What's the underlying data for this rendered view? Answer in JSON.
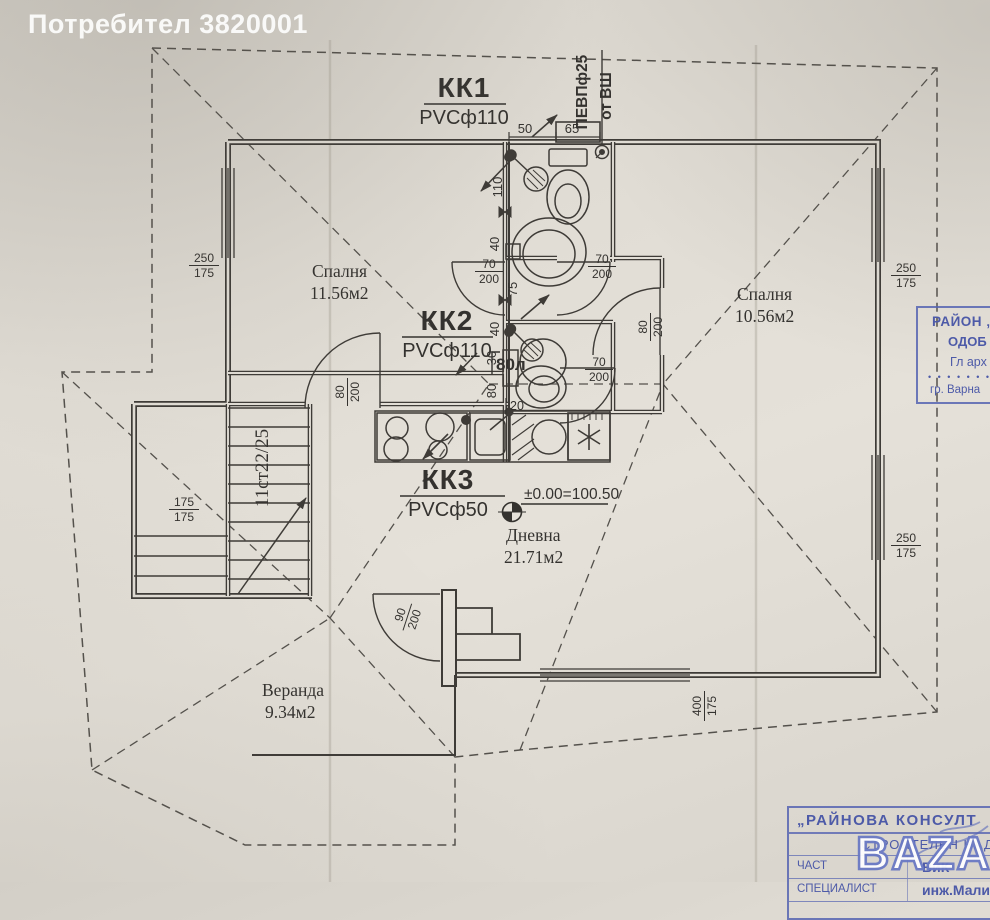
{
  "header": {
    "user_label": "Потребител 3820001"
  },
  "colors": {
    "stamp_blue": "#4d5aa8",
    "line_dark": "#3e3b37"
  },
  "plan": {
    "sewer": {
      "kk1": {
        "title": "КК1",
        "pipe": "PVCф110"
      },
      "kk2": {
        "title": "КК2",
        "pipe": "PVCф110"
      },
      "kk3": {
        "title": "КК3",
        "pipe": "PVCф50"
      },
      "vent": {
        "line1": "ПЕВПф25",
        "line2": "от ВШ"
      }
    },
    "rooms": {
      "bedroom_left": {
        "name": "Спалня",
        "area": "11.56м2"
      },
      "bedroom_right": {
        "name": "Спалня",
        "area": "10.56м2"
      },
      "living": {
        "name": "Дневна",
        "area": "21.71м2"
      },
      "veranda": {
        "name": "Веранда",
        "area": "9.34м2"
      }
    },
    "level_mark": "±0.00=100.50",
    "stairs_label": "11ст22/25",
    "boiler_label": "80л",
    "dims": {
      "d50": "50",
      "d65": "65",
      "d110": "110",
      "d40": "40",
      "d75": "75",
      "d30": "30",
      "d80": "80",
      "d20": "20",
      "door70": {
        "top": "70",
        "bot": "200"
      },
      "door80": {
        "top": "80",
        "bot": "200"
      },
      "door90": {
        "top": "90",
        "bot": "200"
      },
      "win250": {
        "top": "250",
        "bot": "175"
      },
      "win400": {
        "top": "400",
        "bot": "175"
      },
      "win175": {
        "top": "175",
        "bot": "175"
      }
    }
  },
  "stamps": {
    "approval": {
      "line1": "РАЙОН „П",
      "line2": "ОДОБ",
      "line3": "Гл арх",
      "dots": "• • • • • • • • • • • •",
      "line4": "гр. Варна"
    },
    "supervision": {
      "title": "„РАЙНОВА КОНСУЛТ",
      "subtitle": "СТРОИТЕЛЕН НАД",
      "part_label": "ЧАСТ",
      "part_value": "ВиК",
      "specialist_label": "СПЕЦИАЛИСТ",
      "specialist_value": "инж.Малинов"
    }
  },
  "watermark": {
    "text": "BAZAR"
  }
}
